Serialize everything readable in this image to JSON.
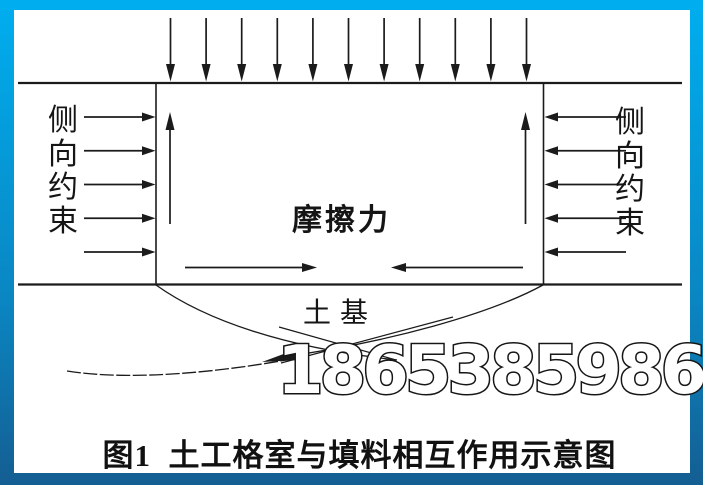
{
  "figure": {
    "caption": "图1  土工格室与填料相互作用示意图",
    "left_label": "侧向约束",
    "right_label": "侧向约束",
    "center_label": "摩擦力",
    "soil_label": "土基",
    "watermark": "18653859869"
  },
  "diagram": {
    "top_load_arrows": 11,
    "side_confinement_arrows_per_side": 5,
    "internal_uplift_arrows": 2,
    "bottom_friction_arrows": 2
  },
  "colors": {
    "frame_gradient_top": "#00aeef",
    "frame_gradient_mid": "#0a86c2",
    "frame_gradient_bottom": "#145e92",
    "ink": "#1b1b1b",
    "background": "#ffffff",
    "watermark_fill": "#ffffff",
    "watermark_outline": "#161616"
  }
}
